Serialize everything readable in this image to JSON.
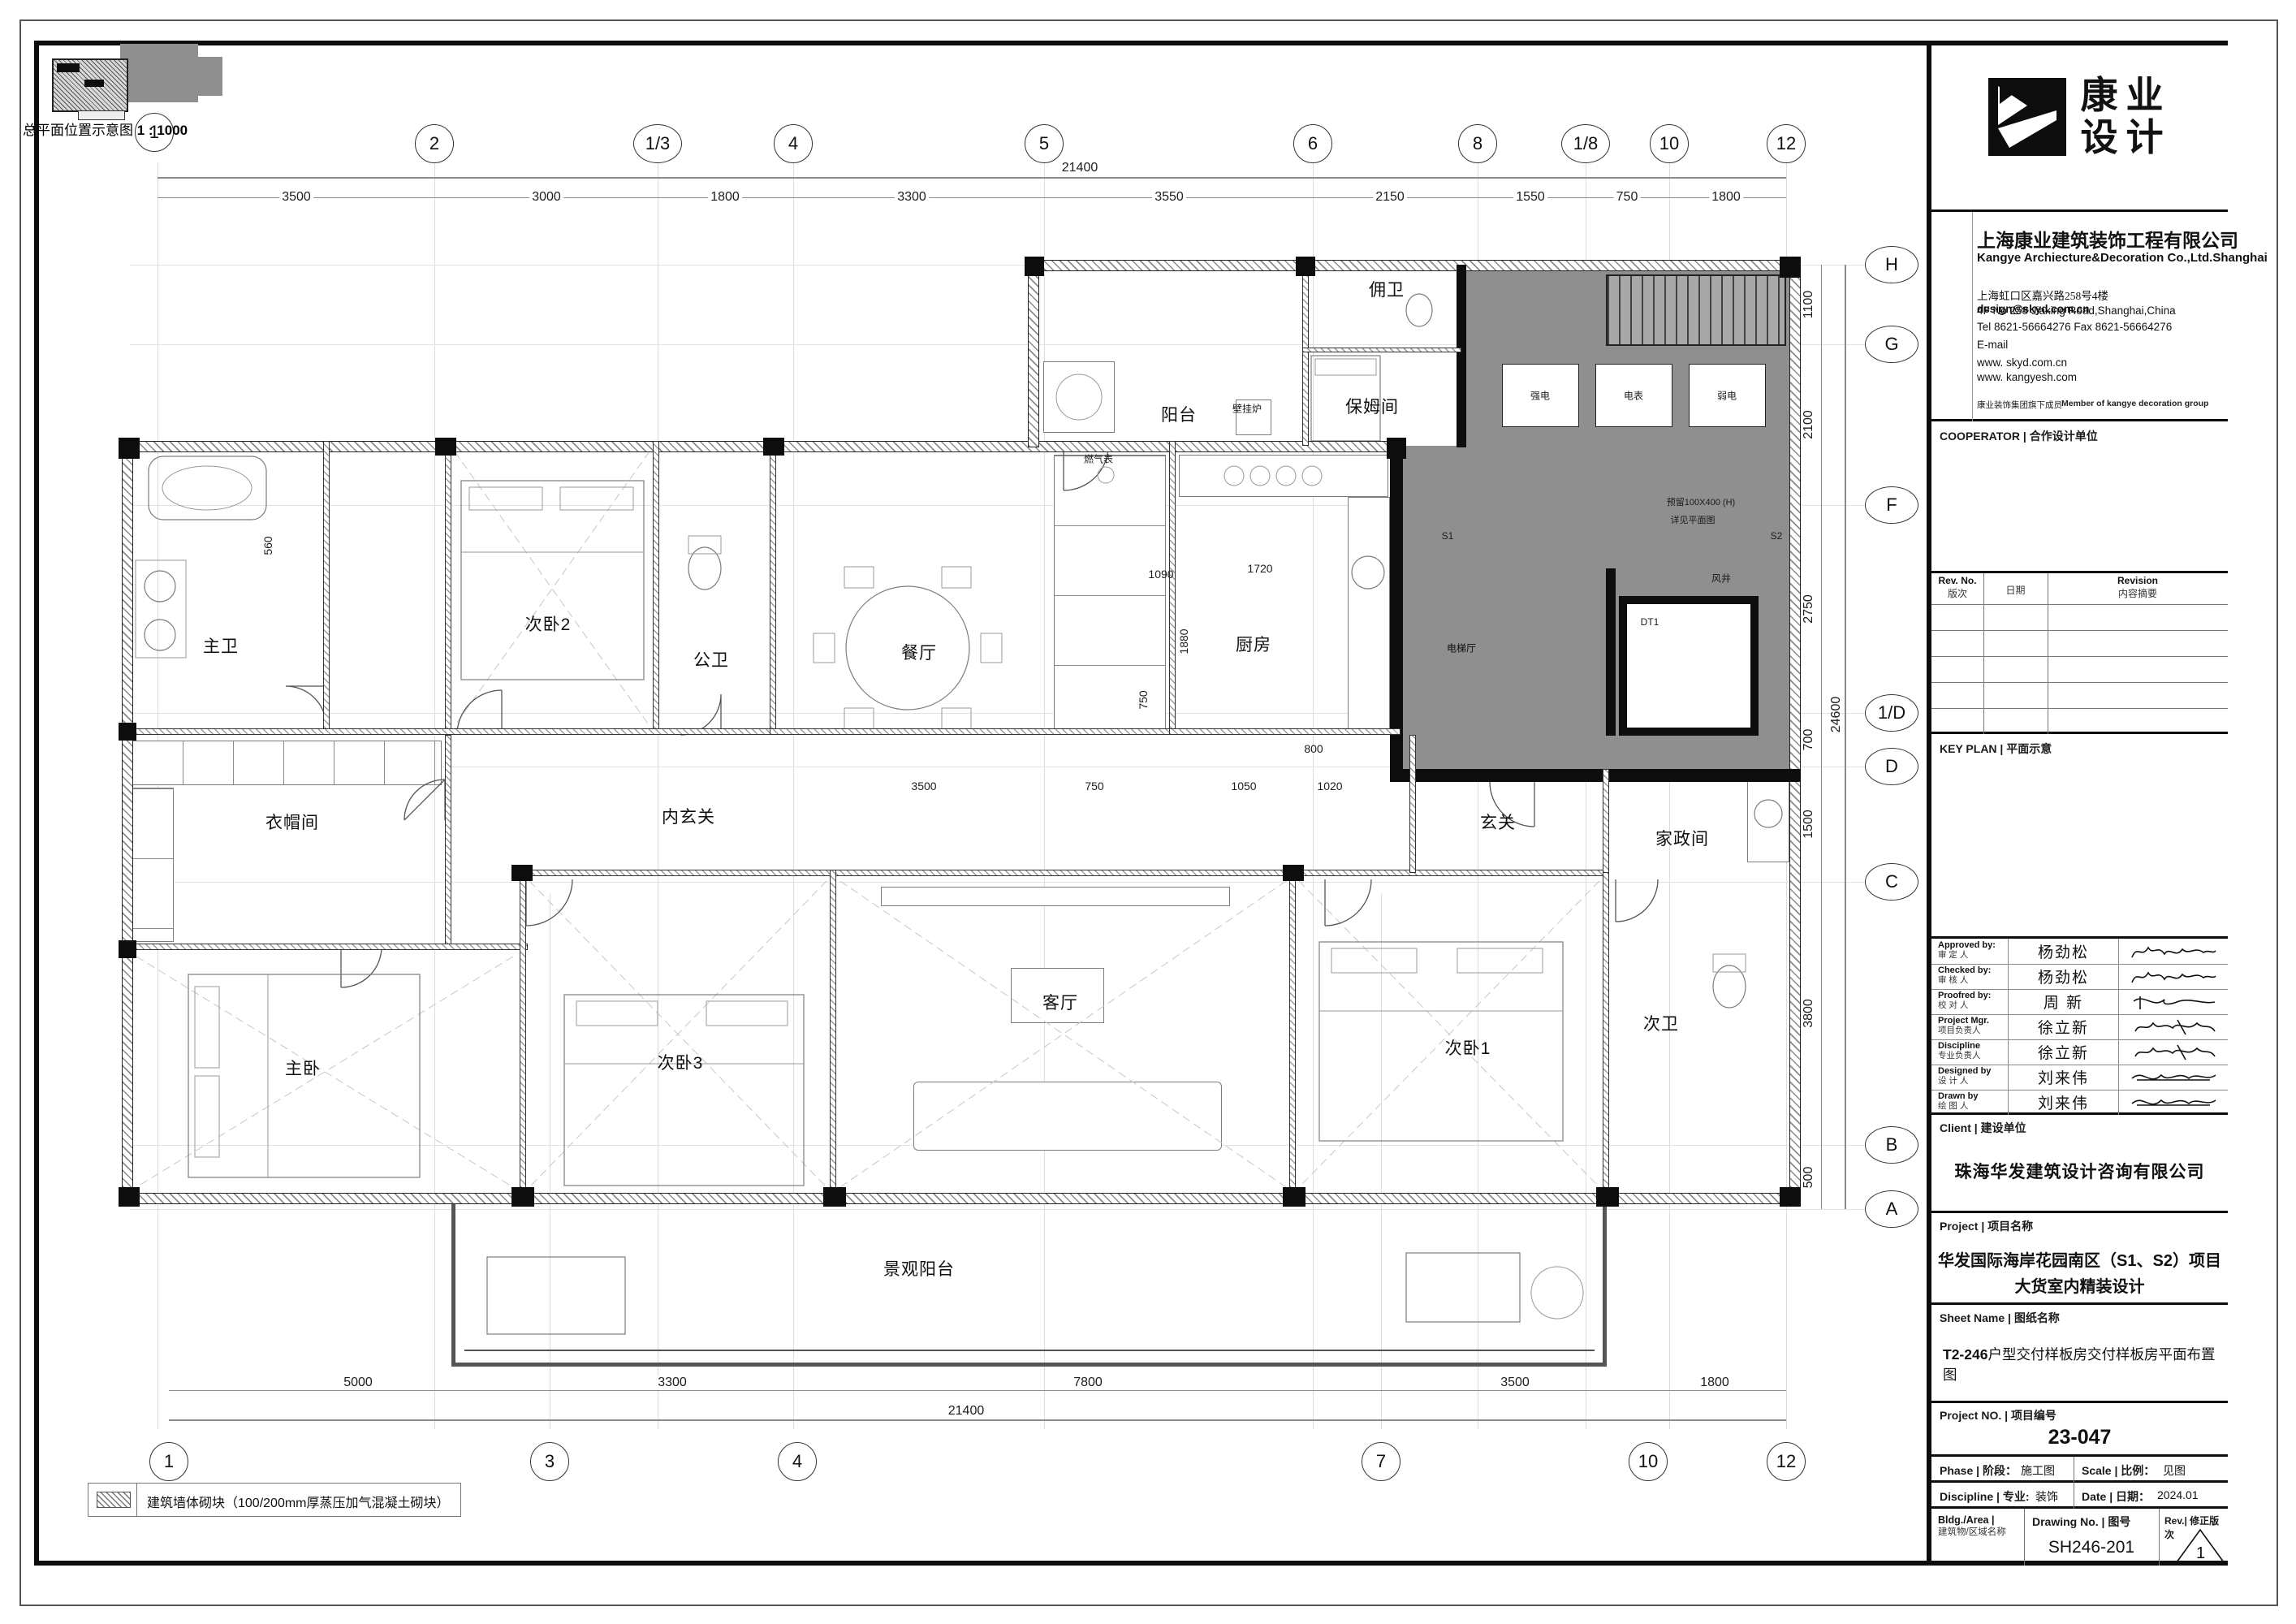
{
  "keyplan": {
    "caption": "总平面位置示意图",
    "scale": "1 : 1000"
  },
  "legend": {
    "text": "建筑墙体砌块（100/200mm厚蒸压加气混凝土砌块）"
  },
  "grid": {
    "top": [
      "1",
      "2",
      "1/3",
      "4",
      "5",
      "6",
      "8",
      "1/8",
      "10",
      "12"
    ],
    "bottom": [
      "1",
      "3",
      "4",
      "7",
      "10",
      "12"
    ],
    "right": [
      "H",
      "G",
      "F",
      "1/D",
      "D",
      "C",
      "B",
      "A"
    ]
  },
  "dims": {
    "top": [
      "3500",
      "3000",
      "1800",
      "3300",
      "3550",
      "2150",
      "1550",
      "750",
      "1800"
    ],
    "top_overall": "21400",
    "bottom": [
      "5000",
      "3300",
      "7800",
      "3500",
      "1800"
    ],
    "bottom_overall": "21400",
    "right": [
      "1100",
      "2100",
      "2750",
      "700",
      "1500",
      "3800",
      "500"
    ],
    "right_overall": "24600",
    "inner": [
      "1090",
      "1720",
      "1880",
      "750",
      "800",
      "3500",
      "750",
      "1050",
      "1020",
      "560"
    ]
  },
  "rooms": [
    "主卫",
    "衣帽间",
    "次卧2",
    "公卫",
    "餐厅",
    "内玄关",
    "厨房",
    "阳台",
    "保姆间",
    "佣卫",
    "玄关",
    "家政间",
    "主卧",
    "次卧3",
    "客厅",
    "次卧1",
    "次卫",
    "景观阳台",
    "电梯厅"
  ],
  "annotations": {
    "s1": "S1",
    "s2": "S2",
    "fengjing": "风井",
    "dt": "DT1",
    "qiangdian": "强电",
    "dianbiao": "电表",
    "ruodian": "弱电",
    "bigualu": "壁挂炉",
    "ranqibiao": "燃气表",
    "note1": "预留100X400 (H)",
    "note2": "详见平面图"
  },
  "tb": {
    "logo_cn_1": "康业",
    "logo_cn_2": "设计",
    "company_cn": "上海康业建筑装饰工程有限公司",
    "company_en": "Kangye Archiecture&Decoration Co.,Ltd.Shanghai",
    "addr_cn": "上海虹口区嘉兴路258号4楼",
    "addr_en": "4F No 258 Jiaxing Road,Shanghai,China",
    "email_overlap": "design@skyd.com.cn",
    "tel": "Tel 8621-56664276  Fax 8621-56664276",
    "email_label": "E-mail",
    "web1": "www. skyd.com.cn",
    "web2": "www. kangyesh.com",
    "member_cn": "康业装饰集团旗下成员",
    "member_en": "Member of kangye decoration group",
    "cooperator": "COOPERATOR | 合作设计单位",
    "rev_no_en": "Rev. No.",
    "rev_no_cn": "版次",
    "date_cn": "日期",
    "revision_en": "Revision",
    "revision_cn": "内容摘要",
    "keyplan_label": "KEY PLAN | 平面示意",
    "approvals": [
      {
        "en": "Approved by:",
        "cn": "审 定 人",
        "name": "杨劲松"
      },
      {
        "en": "Checked by:",
        "cn": "审 核 人",
        "name": "杨劲松"
      },
      {
        "en": "Proofred by:",
        "cn": "校 对 人",
        "name": "周 新"
      },
      {
        "en": "Project Mgr.",
        "cn": "项目负责人",
        "name": "徐立新"
      },
      {
        "en": "Discipline",
        "cn": "专业负责人",
        "name": "徐立新"
      },
      {
        "en": "Designed by",
        "cn": "设 计 人",
        "name": "刘来伟"
      },
      {
        "en": "Drawn by",
        "cn": "绘 图 人",
        "name": "刘来伟"
      }
    ],
    "client_label": "Client | 建设单位",
    "client": "珠海华发建筑设计咨询有限公司",
    "project_label": "Project | 项目名称",
    "project_line1": "华发国际海岸花园南区（S1、S2）项目",
    "project_line2": "大货室内精装设计",
    "sheetname_label": "Sheet Name | 图纸名称",
    "sheetname_prefix": "T2-246",
    "sheetname": "户型交付样板房交付样板房平面布置图",
    "projectno_label": "Project NO. | 项目编号",
    "projectno": "23-047",
    "phase_label": "Phase | 阶段：",
    "phase": "施工图",
    "scale_label": "Scale | 比例：",
    "scale": "见图",
    "discipline_label": "Discipline | 专业:",
    "discipline": "装饰",
    "date_label": "Date | 日期：",
    "date": "2024.01",
    "bldg_label_en": "Bldg./Area |",
    "bldg_label_cn": "建筑物/区域名称",
    "drawingno_label": "Drawing No. | 图号",
    "drawingno": "SH246-201",
    "rev_label": "Rev.| 修正版次",
    "rev": "1"
  }
}
